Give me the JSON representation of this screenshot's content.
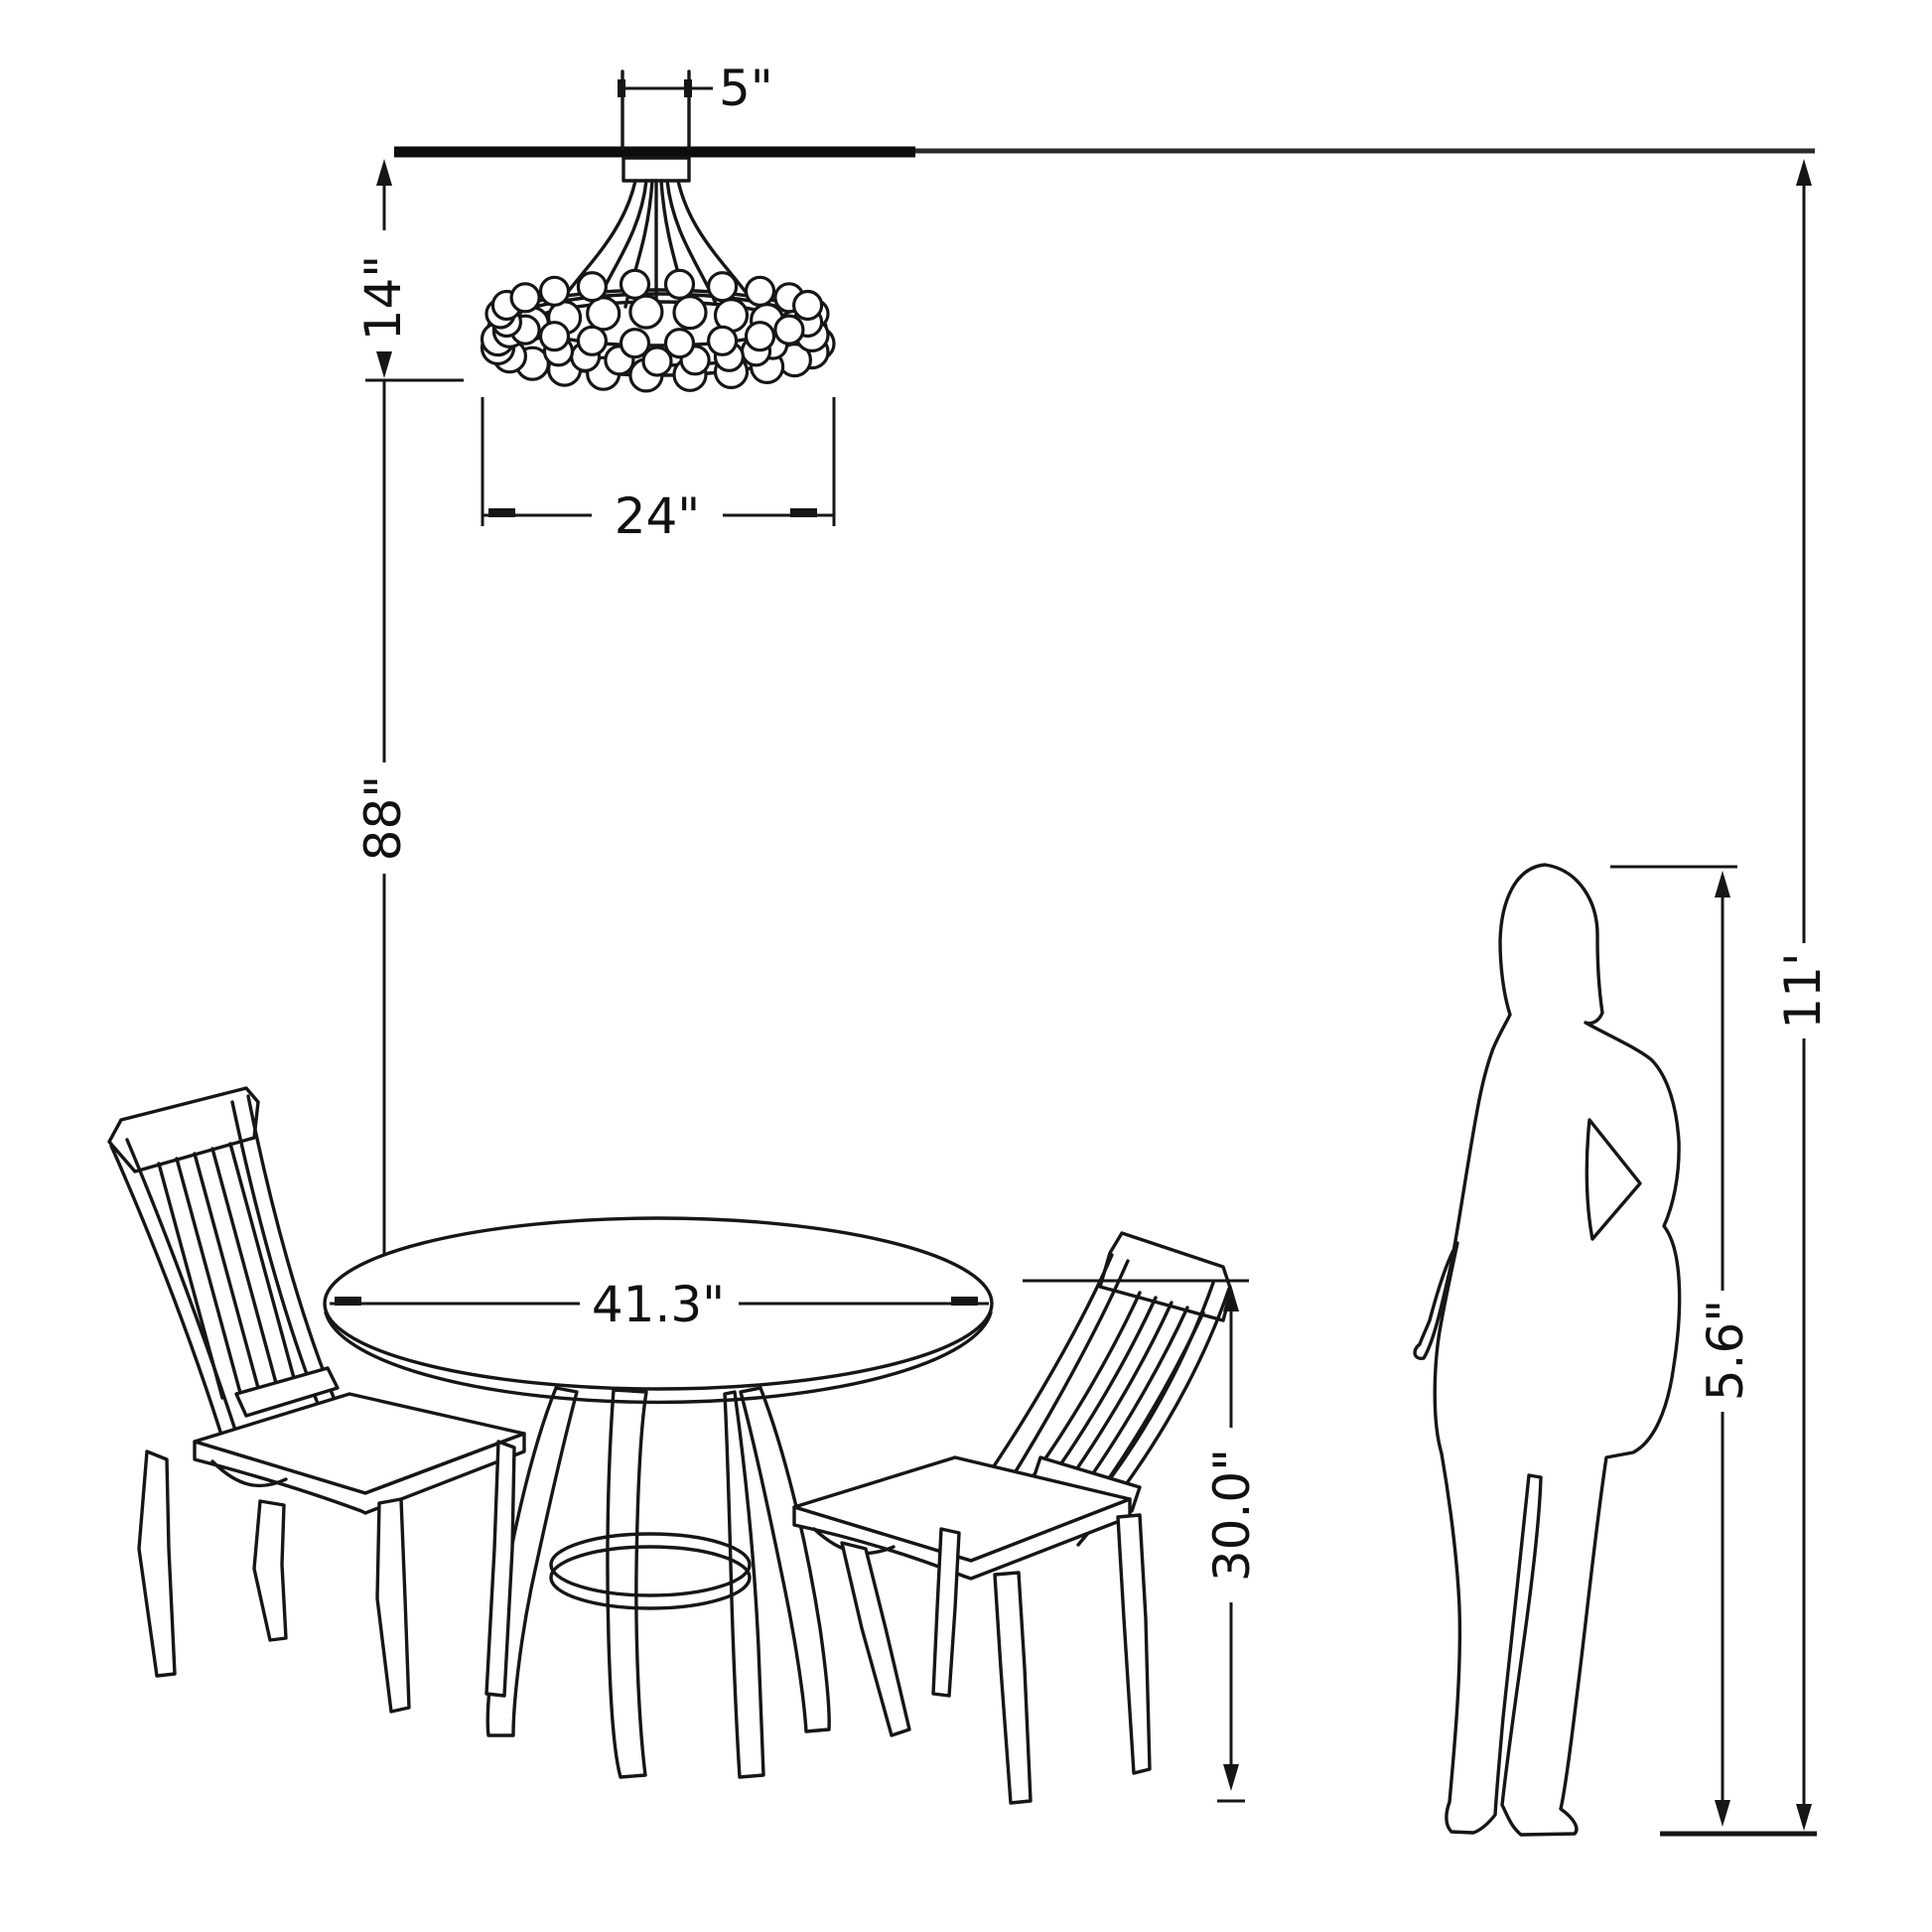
{
  "diagram": {
    "type": "furniture-dimension-drawing",
    "scene": "dining room elevation: ceiling-mounted beaded chandelier above round pedestal dining table with two slat-back chairs and standing woman silhouette for scale",
    "colors": {
      "line": "#161616",
      "background": "#ffffff"
    },
    "dimensions": {
      "canopy_width": "5\"",
      "fixture_height": "14\"",
      "fixture_diameter": "24\"",
      "hang_height": "88\"",
      "table_diameter": "41.3\"",
      "table_height": "30.0\"",
      "person_height": "5.6\"",
      "ceiling_height": "11'"
    }
  }
}
